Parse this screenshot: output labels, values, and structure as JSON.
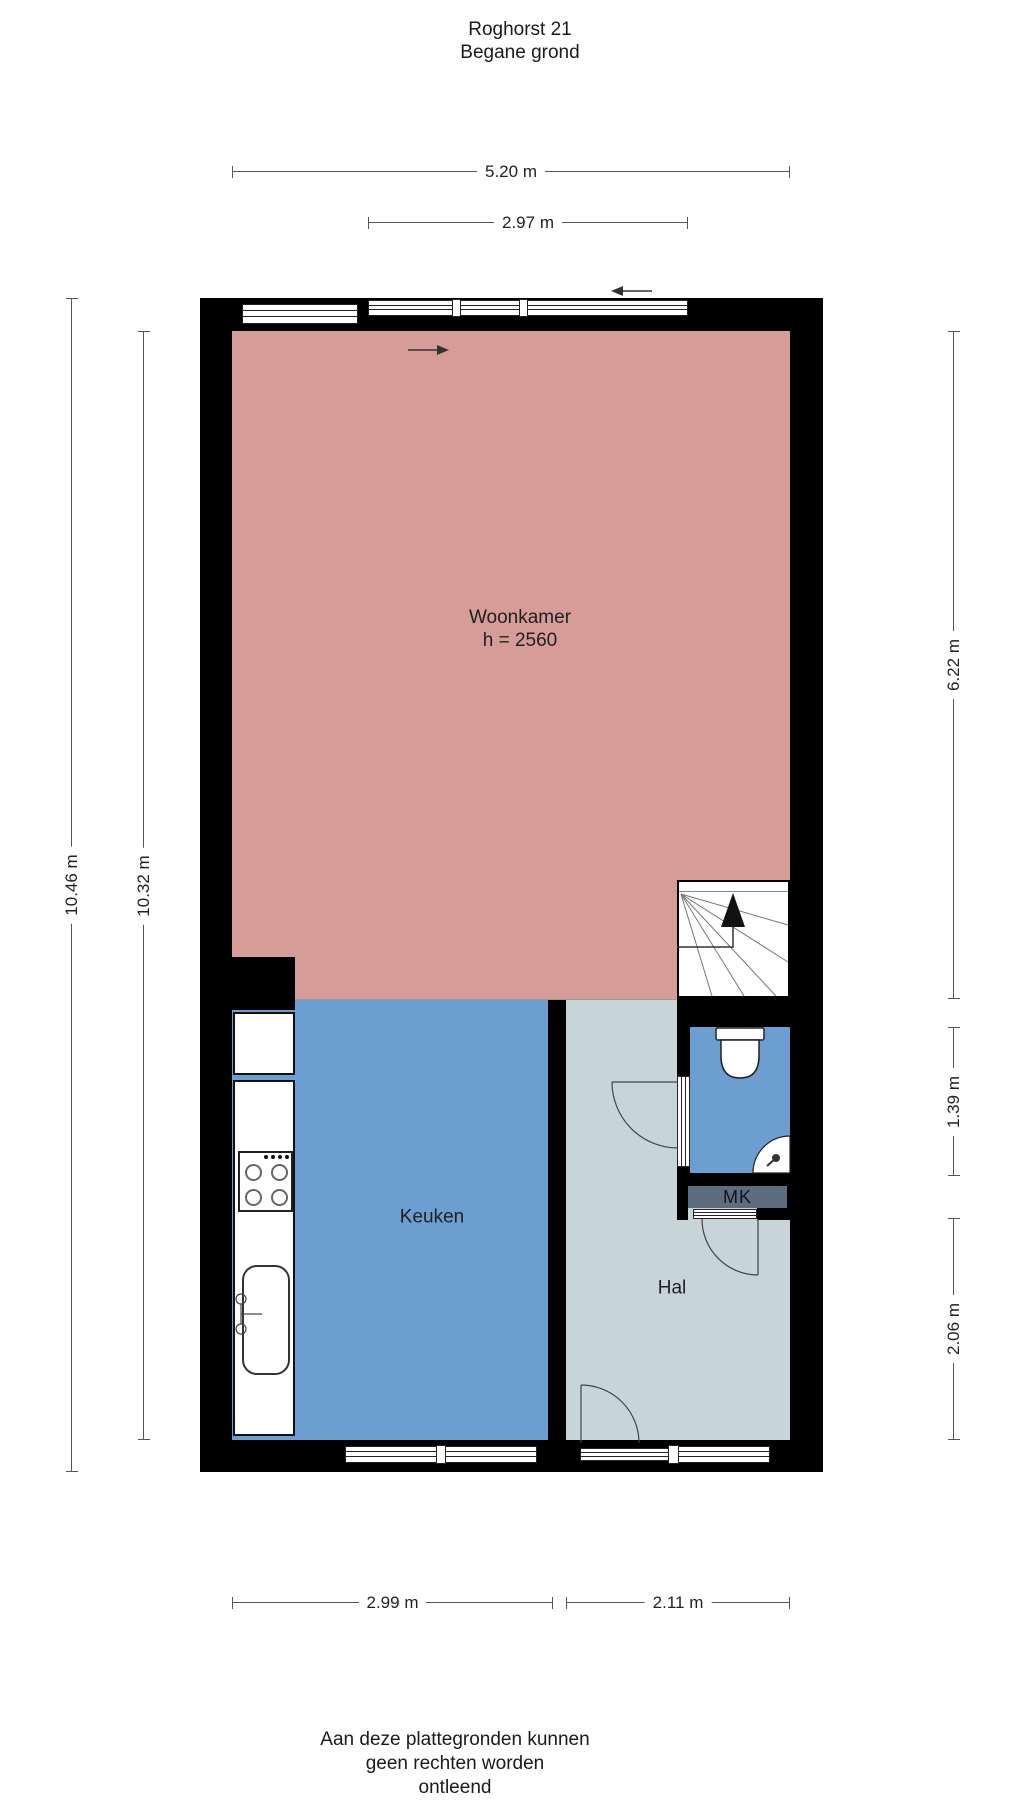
{
  "title": {
    "line1": "Roghorst 21",
    "line2": "Begane grond"
  },
  "rooms": {
    "woonkamer": {
      "label": "Woonkamer",
      "height_note": "h = 2560"
    },
    "keuken": {
      "label": "Keuken"
    },
    "hal": {
      "label": "Hal"
    },
    "mk": {
      "label": "MK"
    }
  },
  "dimensions": {
    "top_total": "5.20 m",
    "top_window": "2.97 m",
    "left_outer": "10.46 m",
    "left_inner": "10.32 m",
    "right_upper": "6.22 m",
    "right_middle": "1.39 m",
    "right_lower": "2.06 m",
    "bottom_left": "2.99 m",
    "bottom_right": "2.11 m"
  },
  "disclaimer": {
    "line1": "Aan deze plattegronden kunnen",
    "line2": "geen rechten worden",
    "line3": "ontleend"
  },
  "colors": {
    "woonkamer": "#D69C97",
    "keuken": "#6C9ED1",
    "hal": "#C7D5D9",
    "toilet": "#6C9ED1",
    "mk": "#5C6E7E",
    "wall": "#000000"
  }
}
